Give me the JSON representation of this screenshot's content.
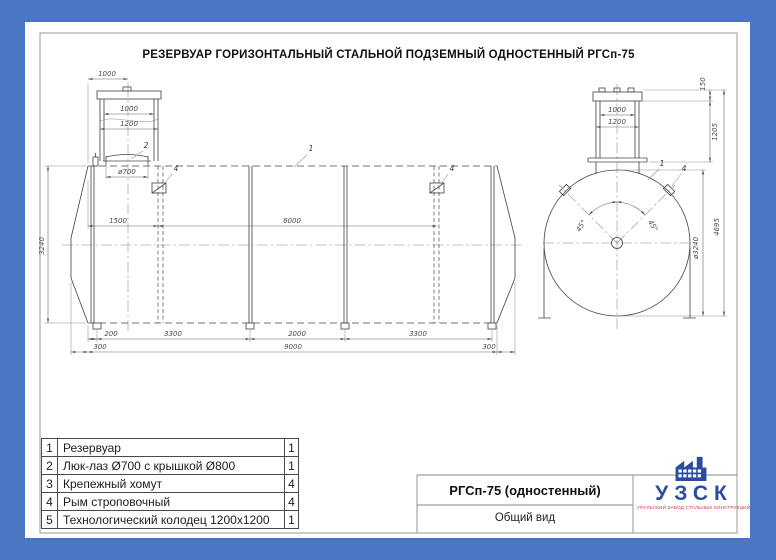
{
  "sheet": {
    "title": "РЕЗЕРВУАР ГОРИЗОНТАЛЬНЫЙ СТАЛЬНОЙ ПОДЗЕМНЫЙ ОДНОСТЕННЫЙ РГСп-75"
  },
  "main_view": {
    "dims": {
      "well_offset": "1000",
      "well_inner": "1000",
      "well_outer": "1200",
      "manhole_dia": "ø700",
      "left_to_clamp": "1500",
      "clamp_span": "6000",
      "shell_height": "3240",
      "foot_offset": "200",
      "bay1": "3300",
      "bay2": "2000",
      "bay3": "3300",
      "head_left": "300",
      "shell_length": "9000",
      "head_right": "300"
    },
    "callouts": {
      "tank": "1",
      "manhole": "2",
      "lug_left": "4",
      "lug_right": "4"
    }
  },
  "end_view": {
    "dims": {
      "cover_height": "150",
      "well_inner": "1000",
      "well_outer": "1200",
      "neck_height": "1205",
      "total_height": "4695",
      "angle_left": "45°",
      "angle_right": "45°",
      "diameter": "ø3240"
    },
    "callouts": {
      "tank": "1",
      "lug": "4"
    }
  },
  "parts_table": {
    "rows": [
      {
        "num": "1",
        "name": "Резервуар",
        "qty": "1"
      },
      {
        "num": "2",
        "name": "Люк-лаз Ø700 с крышкой Ø800",
        "qty": "1"
      },
      {
        "num": "3",
        "name": "Крепежный хомут",
        "qty": "4"
      },
      {
        "num": "4",
        "name": "Рым строповочный",
        "qty": "4"
      },
      {
        "num": "5",
        "name": "Технологический колодец 1200х1200",
        "qty": "1"
      }
    ]
  },
  "title_block": {
    "model": "РГСп-75 (одностенный)",
    "view_name": "Общий вид"
  },
  "logo": {
    "abbr": "УЗСК",
    "tagline": "УРАЛЬСКИЙ ЗАВОД СТАЛЬНЫХ КОНСТРУКЦИЙ"
  },
  "colors": {
    "border_blue": "#4b76c3",
    "logo_blue": "#2b4da0",
    "logo_red": "#c2343c",
    "line": "#4a4a4a"
  }
}
